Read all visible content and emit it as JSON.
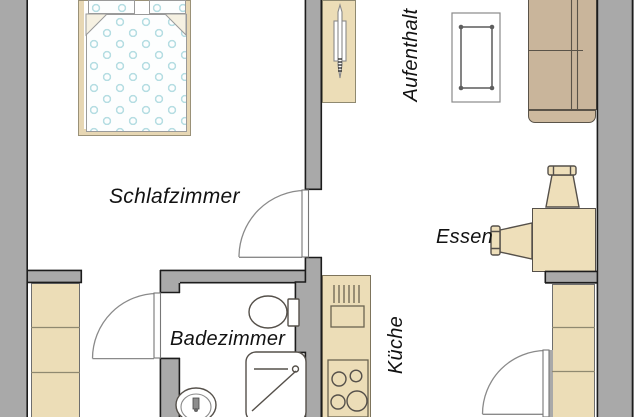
{
  "rooms": {
    "schlafzimmer": "Schlafzimmer",
    "badezimmer": "Badezimmer",
    "kueche": "Küche",
    "essen": "Essen",
    "aufenthalt": "Aufenthalt"
  },
  "fixtures": [
    "double-bed",
    "wardrobe",
    "drying-rack",
    "side-table",
    "sofa",
    "dining-table",
    "chair",
    "chair",
    "tall-cabinet",
    "tall-cabinet",
    "kitchen-counter",
    "kitchen-sink",
    "stove",
    "toilet",
    "shower",
    "washbasin",
    "door-swing",
    "door-swing",
    "door-swing"
  ],
  "colors": {
    "wall": "#a9a9a9",
    "wall-line": "#1c1c1c",
    "furn": "#ecddb7",
    "furn-line": "#8f8970",
    "sofa": "#c9b59b",
    "sofa-line": "#5a5348",
    "dots": "#b5dde2",
    "fixture-line": "#55504a",
    "door-line": "#8a8a8a",
    "label-color": "#121212"
  }
}
